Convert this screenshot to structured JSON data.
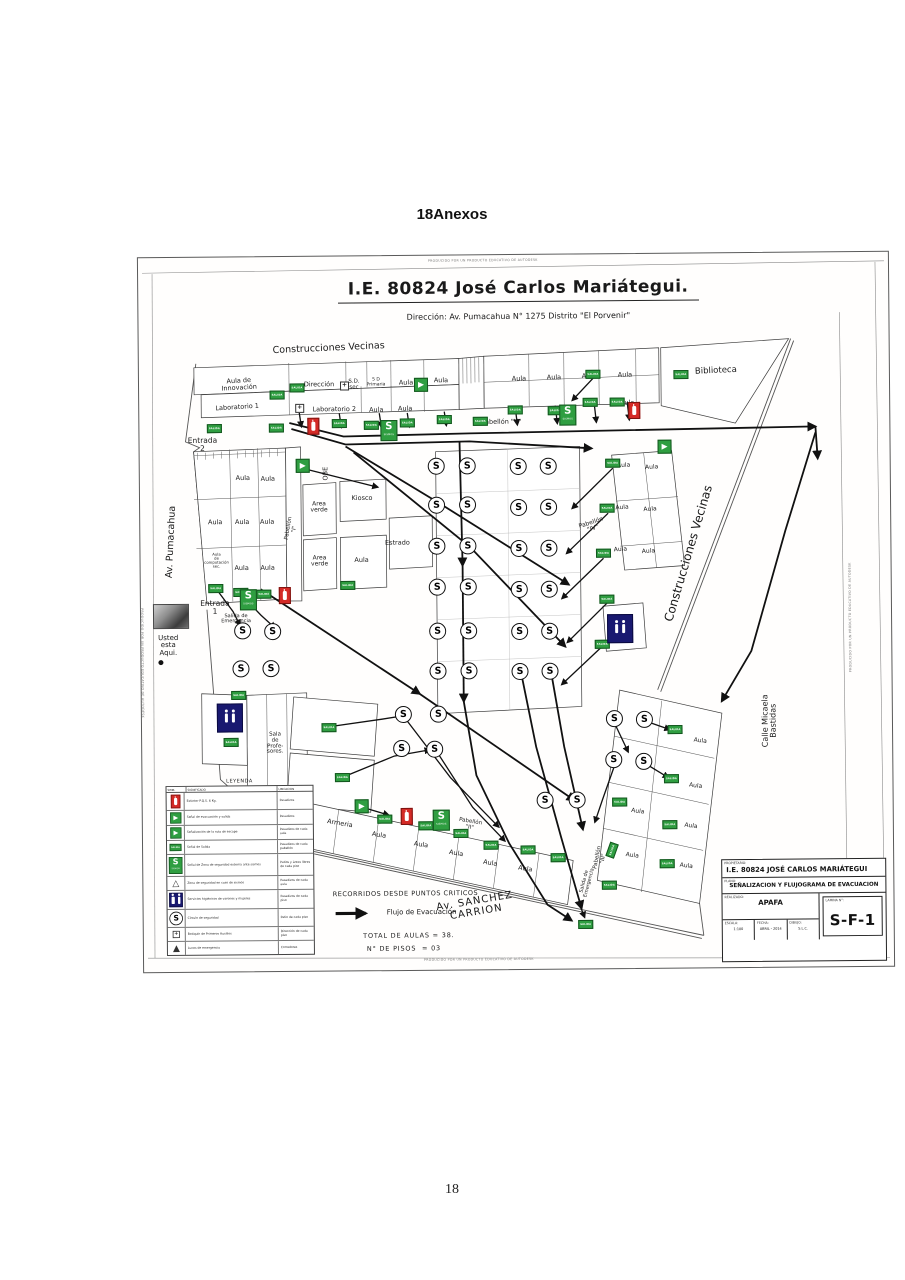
{
  "page": {
    "heading": "18Anexos",
    "page_number": "18"
  },
  "plan": {
    "title": "I.E. 80824 José Carlos Mariátegui.",
    "subtitle": "Dirección: Av. Pumacahua N° 1275 Distrito \"El Porvenir\"",
    "watermark": "PRODUCIDO POR UN PRODUCTO EDUCATIVO DE AUTODESK",
    "glyphs": {
      "s": "S",
      "salida": "SALIDA",
      "sismos": "SISMOS",
      "plus": "+",
      "triangle": "△",
      "lamp": "▲"
    },
    "colors": {
      "sign_green": "#2f9e41",
      "sign_red": "#d42a26",
      "sign_navy": "#191970"
    },
    "labels": [
      {
        "t": "Construcciones Vecinas",
        "x": 190,
        "y": 92,
        "s": 9.5,
        "r": -2
      },
      {
        "t": "Biblioteca",
        "x": 577,
        "y": 118,
        "s": 8.5,
        "r": -2
      },
      {
        "t": "Construcciones Vecinas",
        "x": 548,
        "y": 300,
        "s": 12,
        "r": -73
      },
      {
        "t": "Calle Micaela\nBastidas",
        "x": 628,
        "y": 468,
        "s": 8,
        "r": -90
      },
      {
        "t": "Av. Pumacahua",
        "x": 31,
        "y": 284,
        "s": 9.5,
        "r": -87
      },
      {
        "t": "Av. SANCHEZ\nCARRION",
        "x": 332,
        "y": 652,
        "s": 10,
        "r": -9,
        "ls": 1
      },
      {
        "t": "Entrada\n2",
        "x": 63,
        "y": 187,
        "s": 7.5
      },
      {
        "t": "Entrada\n1",
        "x": 74,
        "y": 350,
        "s": 7.5
      },
      {
        "t": "Salida de\nEmergencia",
        "x": 95,
        "y": 362,
        "s": 5
      },
      {
        "t": "Usted\nesta\nAqui.",
        "x": 27,
        "y": 388,
        "s": 7
      },
      {
        "t": "Salida de\nEmergencia",
        "x": 444,
        "y": 628,
        "s": 5,
        "r": -75
      },
      {
        "t": "Aula de\nInnovación",
        "x": 100,
        "y": 127,
        "s": 6.5,
        "r": -3
      },
      {
        "t": "Laboratorio 1",
        "x": 98,
        "y": 150,
        "s": 6.5,
        "r": -3
      },
      {
        "t": "Dirección",
        "x": 180,
        "y": 128,
        "s": 6.5
      },
      {
        "t": "S.D.\nsec",
        "x": 215,
        "y": 129,
        "s": 5.5
      },
      {
        "t": "5 D\nPrimaria",
        "x": 237,
        "y": 127,
        "s": 4.5
      },
      {
        "t": "Aula",
        "x": 267,
        "y": 127,
        "s": 6.5
      },
      {
        "t": "Aula",
        "x": 302,
        "y": 125,
        "s": 6.5
      },
      {
        "t": "Laboratorio 2",
        "x": 195,
        "y": 153,
        "s": 6.5
      },
      {
        "t": "Aula",
        "x": 237,
        "y": 154,
        "s": 6.5
      },
      {
        "t": "Aula",
        "x": 266,
        "y": 153,
        "s": 6.5
      },
      {
        "t": "Aula",
        "x": 380,
        "y": 124,
        "s": 6.5
      },
      {
        "t": "Aula",
        "x": 415,
        "y": 123,
        "s": 6.5
      },
      {
        "t": "Aula",
        "x": 450,
        "y": 122,
        "s": 6.5
      },
      {
        "t": "Aula",
        "x": 486,
        "y": 121,
        "s": 6.5
      },
      {
        "t": "Aula",
        "x": 488,
        "y": 149,
        "s": 6.5
      },
      {
        "t": "Pabellón \"V\"",
        "x": 362,
        "y": 167,
        "s": 6.5
      },
      {
        "t": "Aula",
        "x": 103,
        "y": 221,
        "s": 6.5
      },
      {
        "t": "Aula",
        "x": 128,
        "y": 222,
        "s": 6.5
      },
      {
        "t": "Aula",
        "x": 75,
        "y": 265,
        "s": 6.5
      },
      {
        "t": "Aula",
        "x": 102,
        "y": 265,
        "s": 6.5
      },
      {
        "t": "Aula",
        "x": 127,
        "y": 265,
        "s": 6.5
      },
      {
        "t": "Aula\nde\ncomputación\nsec.",
        "x": 76,
        "y": 303,
        "s": 3.8
      },
      {
        "t": "Aula",
        "x": 101,
        "y": 311,
        "s": 6.5
      },
      {
        "t": "Aula",
        "x": 127,
        "y": 311,
        "s": 6.5
      },
      {
        "t": "Pabellón\n\"I\"",
        "x": 152,
        "y": 272,
        "s": 5.5,
        "r": -80
      },
      {
        "t": "OBE",
        "x": 186,
        "y": 217,
        "s": 6.5,
        "r": -90
      },
      {
        "t": "Area\nverde",
        "x": 179,
        "y": 251,
        "s": 6
      },
      {
        "t": "Area\nverde",
        "x": 179,
        "y": 305,
        "s": 6
      },
      {
        "t": "Kiosco",
        "x": 222,
        "y": 242,
        "s": 6.5
      },
      {
        "t": "Estrado",
        "x": 257,
        "y": 287,
        "s": 6.5
      },
      {
        "t": "Aula",
        "x": 221,
        "y": 304,
        "s": 6.5
      },
      {
        "t": "Pabellón\n\"IV\"",
        "x": 452,
        "y": 272,
        "s": 6,
        "r": -18
      },
      {
        "t": "Aula",
        "x": 484,
        "y": 212,
        "s": 6,
        "r": -3
      },
      {
        "t": "Aula",
        "x": 512,
        "y": 214,
        "s": 6,
        "r": -3
      },
      {
        "t": "Aula",
        "x": 482,
        "y": 254,
        "s": 6,
        "r": -3
      },
      {
        "t": "Aula",
        "x": 510,
        "y": 256,
        "s": 6,
        "r": -3
      },
      {
        "t": "Aula",
        "x": 480,
        "y": 296,
        "s": 6,
        "r": -3
      },
      {
        "t": "Aula",
        "x": 508,
        "y": 298,
        "s": 6,
        "r": -3
      },
      {
        "t": "Aula",
        "x": 558,
        "y": 488,
        "s": 6,
        "r": 8
      },
      {
        "t": "Aula",
        "x": 553,
        "y": 533,
        "s": 6,
        "r": 8
      },
      {
        "t": "Aula",
        "x": 548,
        "y": 573,
        "s": 6,
        "r": 8
      },
      {
        "t": "Aula",
        "x": 543,
        "y": 613,
        "s": 6,
        "r": 8
      },
      {
        "t": "Aula",
        "x": 495,
        "y": 558,
        "s": 6,
        "r": 8
      },
      {
        "t": "Aula",
        "x": 489,
        "y": 602,
        "s": 6,
        "r": 8
      },
      {
        "t": "Pabellón\n\"III\"",
        "x": 458,
        "y": 604,
        "s": 5.5,
        "r": -78
      },
      {
        "t": "Armeria",
        "x": 197,
        "y": 567,
        "s": 6.5,
        "r": 10
      },
      {
        "t": "Aula",
        "x": 236,
        "y": 579,
        "s": 6.5,
        "r": 10
      },
      {
        "t": "Aula",
        "x": 278,
        "y": 589,
        "s": 6.5,
        "r": 10
      },
      {
        "t": "Aula",
        "x": 313,
        "y": 598,
        "s": 6.5,
        "r": 10
      },
      {
        "t": "Aula",
        "x": 347,
        "y": 608,
        "s": 6.5,
        "r": 10
      },
      {
        "t": "Aula",
        "x": 382,
        "y": 614,
        "s": 6.5,
        "r": 10
      },
      {
        "t": "Pabellón\n\"II\"",
        "x": 327,
        "y": 570,
        "s": 5.5,
        "r": 10
      },
      {
        "t": "Sala\nde\nProfe-\nsores.",
        "x": 133,
        "y": 487,
        "s": 5.5
      },
      {
        "t": "RECORRIDOS DESDE PUNTOS CRITICOS",
        "x": 262,
        "y": 638,
        "s": 6.5,
        "ls": 0.5
      },
      {
        "t": "Flujo de Evacuación",
        "x": 278,
        "y": 657,
        "s": 7
      },
      {
        "t": "TOTAL DE AULAS = 38.",
        "x": 265,
        "y": 680,
        "s": 6.5,
        "ls": 0.8
      },
      {
        "t": "N° DE PISOS  = 03",
        "x": 260,
        "y": 693,
        "s": 6.5,
        "ls": 0.8
      }
    ],
    "s_circles": [
      [
        297,
        211
      ],
      [
        328,
        211
      ],
      [
        379,
        212
      ],
      [
        409,
        212
      ],
      [
        297,
        250
      ],
      [
        328,
        250
      ],
      [
        379,
        253
      ],
      [
        409,
        253
      ],
      [
        297,
        291
      ],
      [
        328,
        291
      ],
      [
        379,
        294
      ],
      [
        409,
        294
      ],
      [
        297,
        332
      ],
      [
        328,
        332
      ],
      [
        379,
        335
      ],
      [
        409,
        335
      ],
      [
        297,
        376
      ],
      [
        328,
        376
      ],
      [
        379,
        377
      ],
      [
        409,
        377
      ],
      [
        297,
        416
      ],
      [
        328,
        416
      ],
      [
        379,
        417
      ],
      [
        409,
        417
      ],
      [
        102,
        374
      ],
      [
        132,
        375
      ],
      [
        100,
        412
      ],
      [
        130,
        412
      ],
      [
        262,
        459
      ],
      [
        297,
        459
      ],
      [
        260,
        493
      ],
      [
        293,
        494
      ],
      [
        403,
        546
      ],
      [
        435,
        546
      ],
      [
        473,
        465
      ],
      [
        503,
        466
      ],
      [
        472,
        506
      ],
      [
        502,
        508
      ]
    ],
    "exit_signs": [
      [
        137,
        171
      ],
      [
        75,
        171
      ],
      [
        138,
        138
      ],
      [
        158,
        131
      ],
      [
        200,
        167
      ],
      [
        232,
        169
      ],
      [
        268,
        167
      ],
      [
        305,
        164
      ],
      [
        341,
        166
      ],
      [
        376,
        155
      ],
      [
        416,
        156
      ],
      [
        451,
        148
      ],
      [
        478,
        148
      ],
      [
        454,
        120
      ],
      [
        542,
        121
      ],
      [
        473,
        209
      ],
      [
        467,
        254
      ],
      [
        463,
        299
      ],
      [
        466,
        345
      ],
      [
        461,
        390
      ],
      [
        75,
        331
      ],
      [
        100,
        335
      ],
      [
        123,
        337
      ],
      [
        97,
        438
      ],
      [
        89,
        485
      ],
      [
        187,
        471
      ],
      [
        200,
        521
      ],
      [
        207,
        329
      ],
      [
        242,
        563
      ],
      [
        283,
        570
      ],
      [
        318,
        578
      ],
      [
        348,
        590
      ],
      [
        385,
        595
      ],
      [
        415,
        603
      ],
      [
        477,
        548
      ],
      [
        469,
        596,
        -70
      ],
      [
        466,
        631
      ],
      [
        442,
        670
      ],
      [
        533,
        476
      ],
      [
        529,
        525
      ],
      [
        527,
        571
      ],
      [
        524,
        610
      ]
    ],
    "arrow_signs": [
      [
        162,
        208
      ],
      [
        281,
        128
      ],
      [
        524,
        192
      ],
      [
        218,
        549
      ]
    ],
    "sismo_signs": [
      [
        249,
        174
      ],
      [
        428,
        160
      ],
      [
        107,
        342
      ],
      [
        298,
        564
      ]
    ],
    "ext_signs": [
      [
        173,
        169
      ],
      [
        143,
        338
      ],
      [
        263,
        560
      ],
      [
        494,
        156
      ]
    ],
    "wc_signs": [
      [
        87,
        460
      ],
      [
        478,
        374
      ]
    ],
    "plus_signs": [
      [
        205,
        129
      ],
      [
        160,
        151
      ]
    ],
    "you_are_here": {
      "x": 19,
      "y": 404
    },
    "photo": {
      "x": 12,
      "y": 346,
      "w": 34,
      "h": 23
    },
    "legend": {
      "title": "LEYENDA",
      "headers": {
        "sym": "SIMB.",
        "desc": "SIGNIFICADO",
        "loc": "UBICACION"
      },
      "rows": [
        {
          "icon": "ext",
          "d": "Extintor P.Q.S. 6 Kg.",
          "u": "Pasadizos"
        },
        {
          "icon": "run",
          "d": "Señal de evacuación y salida",
          "u": "Pasadizos"
        },
        {
          "icon": "arrow",
          "d": "Señalización de la ruta de escape",
          "u": "Pasadizos de cada aula"
        },
        {
          "icon": "salida",
          "d": "Señal de Salida",
          "u": "Pasadizos de cada pabellón"
        },
        {
          "icon": "sismo",
          "d": "Señal de Zona de seguridad externa ante sismos",
          "u": "Patios y áreas libres de cada piso"
        },
        {
          "icon": "tri",
          "d": "Zona de seguridad en caso de sismos",
          "u": "Pasadizos de cada aula"
        },
        {
          "icon": "wc",
          "d": "Servicios higiénicos de varones y mujeres",
          "u": "Pasadizos de cada piso"
        },
        {
          "icon": "circle",
          "d": "Círculo de seguridad",
          "u": "Patio de cada piso"
        },
        {
          "icon": "cross",
          "d": "Botiquín de Primeros Auxilios",
          "u": "Dirección de cada piso"
        },
        {
          "icon": "lamp",
          "d": "Luces de emergencia",
          "u": "Corredores"
        }
      ]
    },
    "titleblock": {
      "owner_label": "PROPIETARIO:",
      "owner": "I.E. 80824 JOSÉ CARLOS MARIÁTEGUI",
      "plan_label": "PLANO:",
      "plan_title": "SEÑALIZACION Y FLUJOGRAMA DE EVACUACION",
      "made_label": "REALIZADO:",
      "made_by": "APAFA",
      "scale_label": "ESCALA:",
      "scale": "1:100",
      "date_label": "FECHA:",
      "date": "ABRIL - 2014",
      "draw_label": "DIBUJO:",
      "draw": "S.L.C.",
      "sheet_label": "LAMINA N°:",
      "sheet": "S-F-1"
    }
  }
}
